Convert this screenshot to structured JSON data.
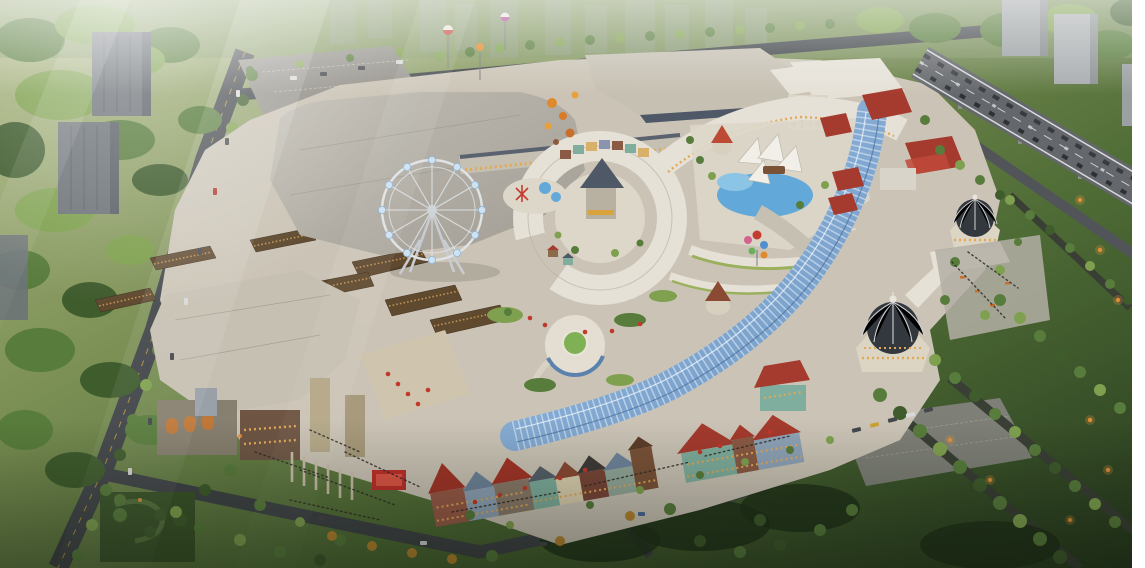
{
  "scene": {
    "type": "aerial-architectural-rendering",
    "subject": "bird's-eye 3D rendering of a European-style open-air shopping mall and entertainment complex at dusk",
    "features": [
      "ferris-wheel",
      "serpentine-glass-ribbon-canopy",
      "twin-domed-pavilions",
      "colorful-townhouse-retail-street",
      "stone-entrance-gate-plaza",
      "central-ring-courtyard",
      "pyramid-roof-tower",
      "water-play-plaza-with-sail-tents",
      "balloon-decorations",
      "elevated-highway-with-traffic",
      "residential-towers",
      "tree-lined-park",
      "surface-parking-lots"
    ]
  },
  "palette": {
    "grass_light": "#a9b47d",
    "grass_mid": "#6d8a4a",
    "grass_dark": "#2c4423",
    "lawn_dusk": "#1f3119",
    "tree_dark": "#3f5c2d",
    "tree_mid": "#587c3c",
    "tree_light": "#7fa14f",
    "tree_autumn": "#b9862f",
    "road": "#3f4347",
    "road_line": "#c9a23c",
    "highway_deck": "#64676b",
    "highway_stripe": "#d9dadc",
    "paving": "#cbc4b6",
    "paving_light": "#ddd7ca",
    "paving_dusk": "#b4afa6",
    "roof_big": "#b2aea6",
    "roof_warm": "#c6c0b2",
    "roof_white": "#e5e1d7",
    "roof_slate": "#4e5866",
    "roof_red": "#a53a2e",
    "roof_red_bright": "#bc4a34",
    "roof_blue": "#7a8ea4",
    "wall_cream": "#ddd5c4",
    "wall_brick": "#8a5a44",
    "wall_stone": "#877f6f",
    "wall_teal": "#7fae9e",
    "wall_dark_red": "#7a4538",
    "dome_dark": "#33383f",
    "dome_rib": "#cfd2d4",
    "glass_blue": "#8fb6de",
    "glass_blue_deep": "#5b82ad",
    "glass_lattice": "#e9f2fa",
    "water": "#62a8d8",
    "window_warm": "#e2a955",
    "umbrella_red": "#c0392b",
    "balloon_orange": "#e08a2e",
    "balloon_pink": "#d4628f",
    "balloon_blue": "#4f8fd0",
    "balloon_green": "#69b05c",
    "balloon_red": "#c43b2f",
    "wheel_steel": "#dfe3e6",
    "gondola": "#cfe2f2",
    "crowd": "#2e2a26",
    "car_dark": "#44474c",
    "car_light": "#d8d8d8",
    "lamp_glow": "#e8953a",
    "courtyard_wood": "#5f4a30",
    "storefront_amber": "#c89858",
    "edge_white": "#ffffff"
  }
}
